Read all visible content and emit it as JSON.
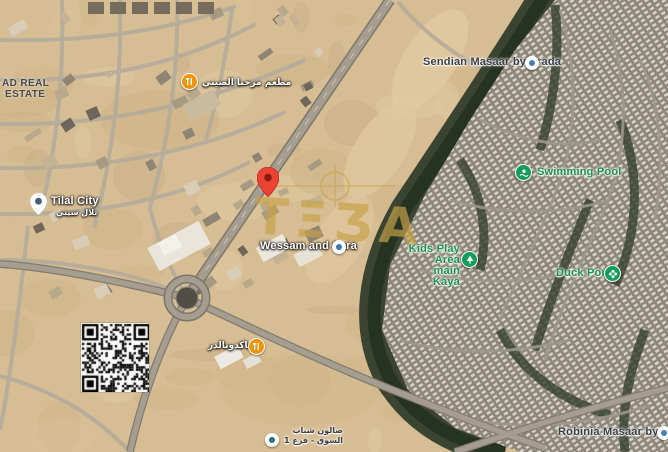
{
  "map": {
    "kind": "satellite-map-screenshot",
    "watermark": {
      "text": "TΞƷA",
      "color": "#c8a24a"
    },
    "pois": {
      "district_label": {
        "line1": "AD REAL",
        "line2": "ESTATE"
      },
      "chinese_restaurant": {
        "label_ar": "مطعم مرحبا الصيني"
      },
      "tilal_city": {
        "label": "Tilal City",
        "label_ar": "تلال سيتي"
      },
      "sendian": {
        "label": "Sendian Masaar by Arada"
      },
      "swimming_pool": {
        "label": "Swimming Pool"
      },
      "kids_play_area": {
        "line1": "Kids Play Area",
        "line2": "main Kaya"
      },
      "duck_pond": {
        "label": "Duck Pond"
      },
      "wessam_and_sara": {
        "label": "Wessam and Sara"
      },
      "robinia": {
        "label": "Robinia Masaar by Arada"
      },
      "mcdonalds": {
        "label_ar": "ماكدونالدز"
      },
      "salon": {
        "line1_ar": "صالون شباب",
        "line2_ar": "السوق - فرع 1"
      }
    },
    "colors": {
      "desert_base": "#d7bd94",
      "road_gray": "#a49d90",
      "vegetation_dark": "#2e3a28",
      "housing_base": "#8d8679",
      "poi_green": "#169c5b",
      "poi_orange": "#f0930f",
      "pin_red": "#ea4335",
      "label_green": "#1d9150",
      "watermark_gold": "#c8a24a"
    }
  }
}
